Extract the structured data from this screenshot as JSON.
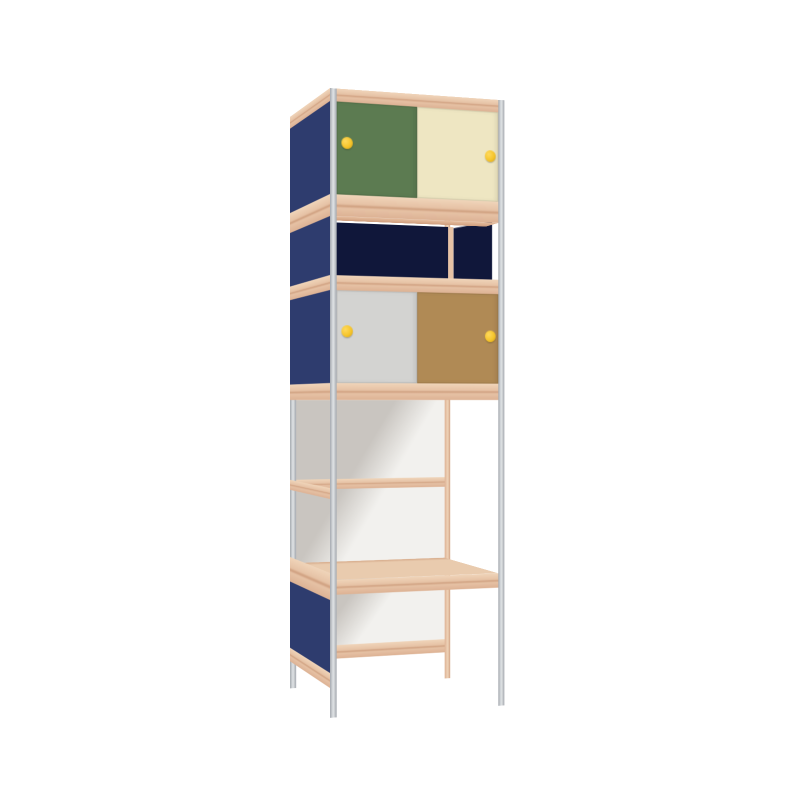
{
  "image": {
    "kind": "3d-product-render",
    "subject": "tall modular shelving cabinet with metal posts, plywood shelves and colored panels",
    "background_color": "#ffffff",
    "text_content": "none"
  },
  "palette": {
    "plywood-light": "#f0d5ba",
    "plywood": "#e6c2a5",
    "plywood-mid": "#ddb294",
    "plywood-dark": "#cf9f7f",
    "metal": "#c6c9cd",
    "metal-light": "#d6d9dc",
    "metal-dark": "#a2a7ad",
    "navy-panel": "#2e3c6e",
    "navy-dark": "#10173a",
    "door-green": "#5c7b51",
    "door-cream": "#eee6c2",
    "door-gray": "#d3d3d1",
    "door-brown": "#b08a55",
    "knob-yellow": "#f6c52b",
    "knob-yellow-dark": "#d29e12",
    "back-white": "#f2f1ee",
    "back-shadow": "#c9c5c0",
    "shelf-top": "#e9cbae"
  },
  "unit": {
    "frame": {
      "front_posts": "gray metal",
      "back_left_post": "gray metal",
      "back_right_post": "plywood",
      "shelves": "plywood edge bands"
    },
    "sections_top_to_bottom": [
      {
        "name": "upper-cabinet",
        "doors": [
          "green sliding door",
          "cream sliding door"
        ],
        "knobs": "yellow round"
      },
      {
        "name": "drawer-row",
        "fronts": [
          "wide navy box",
          "narrow navy box"
        ],
        "recessed": true
      },
      {
        "name": "lower-cabinet",
        "doors": [
          "gray sliding door",
          "brown sliding door"
        ],
        "knobs": "yellow round"
      },
      {
        "name": "open-shelf-bay",
        "back": "white panel with diagonal shadow",
        "mid_rail": "plywood"
      },
      {
        "name": "bottom-bay",
        "shelf": "plywood top",
        "back": "white panel",
        "left_side": "navy panel"
      }
    ],
    "left_side_panels": "navy blue with plywood rails"
  }
}
